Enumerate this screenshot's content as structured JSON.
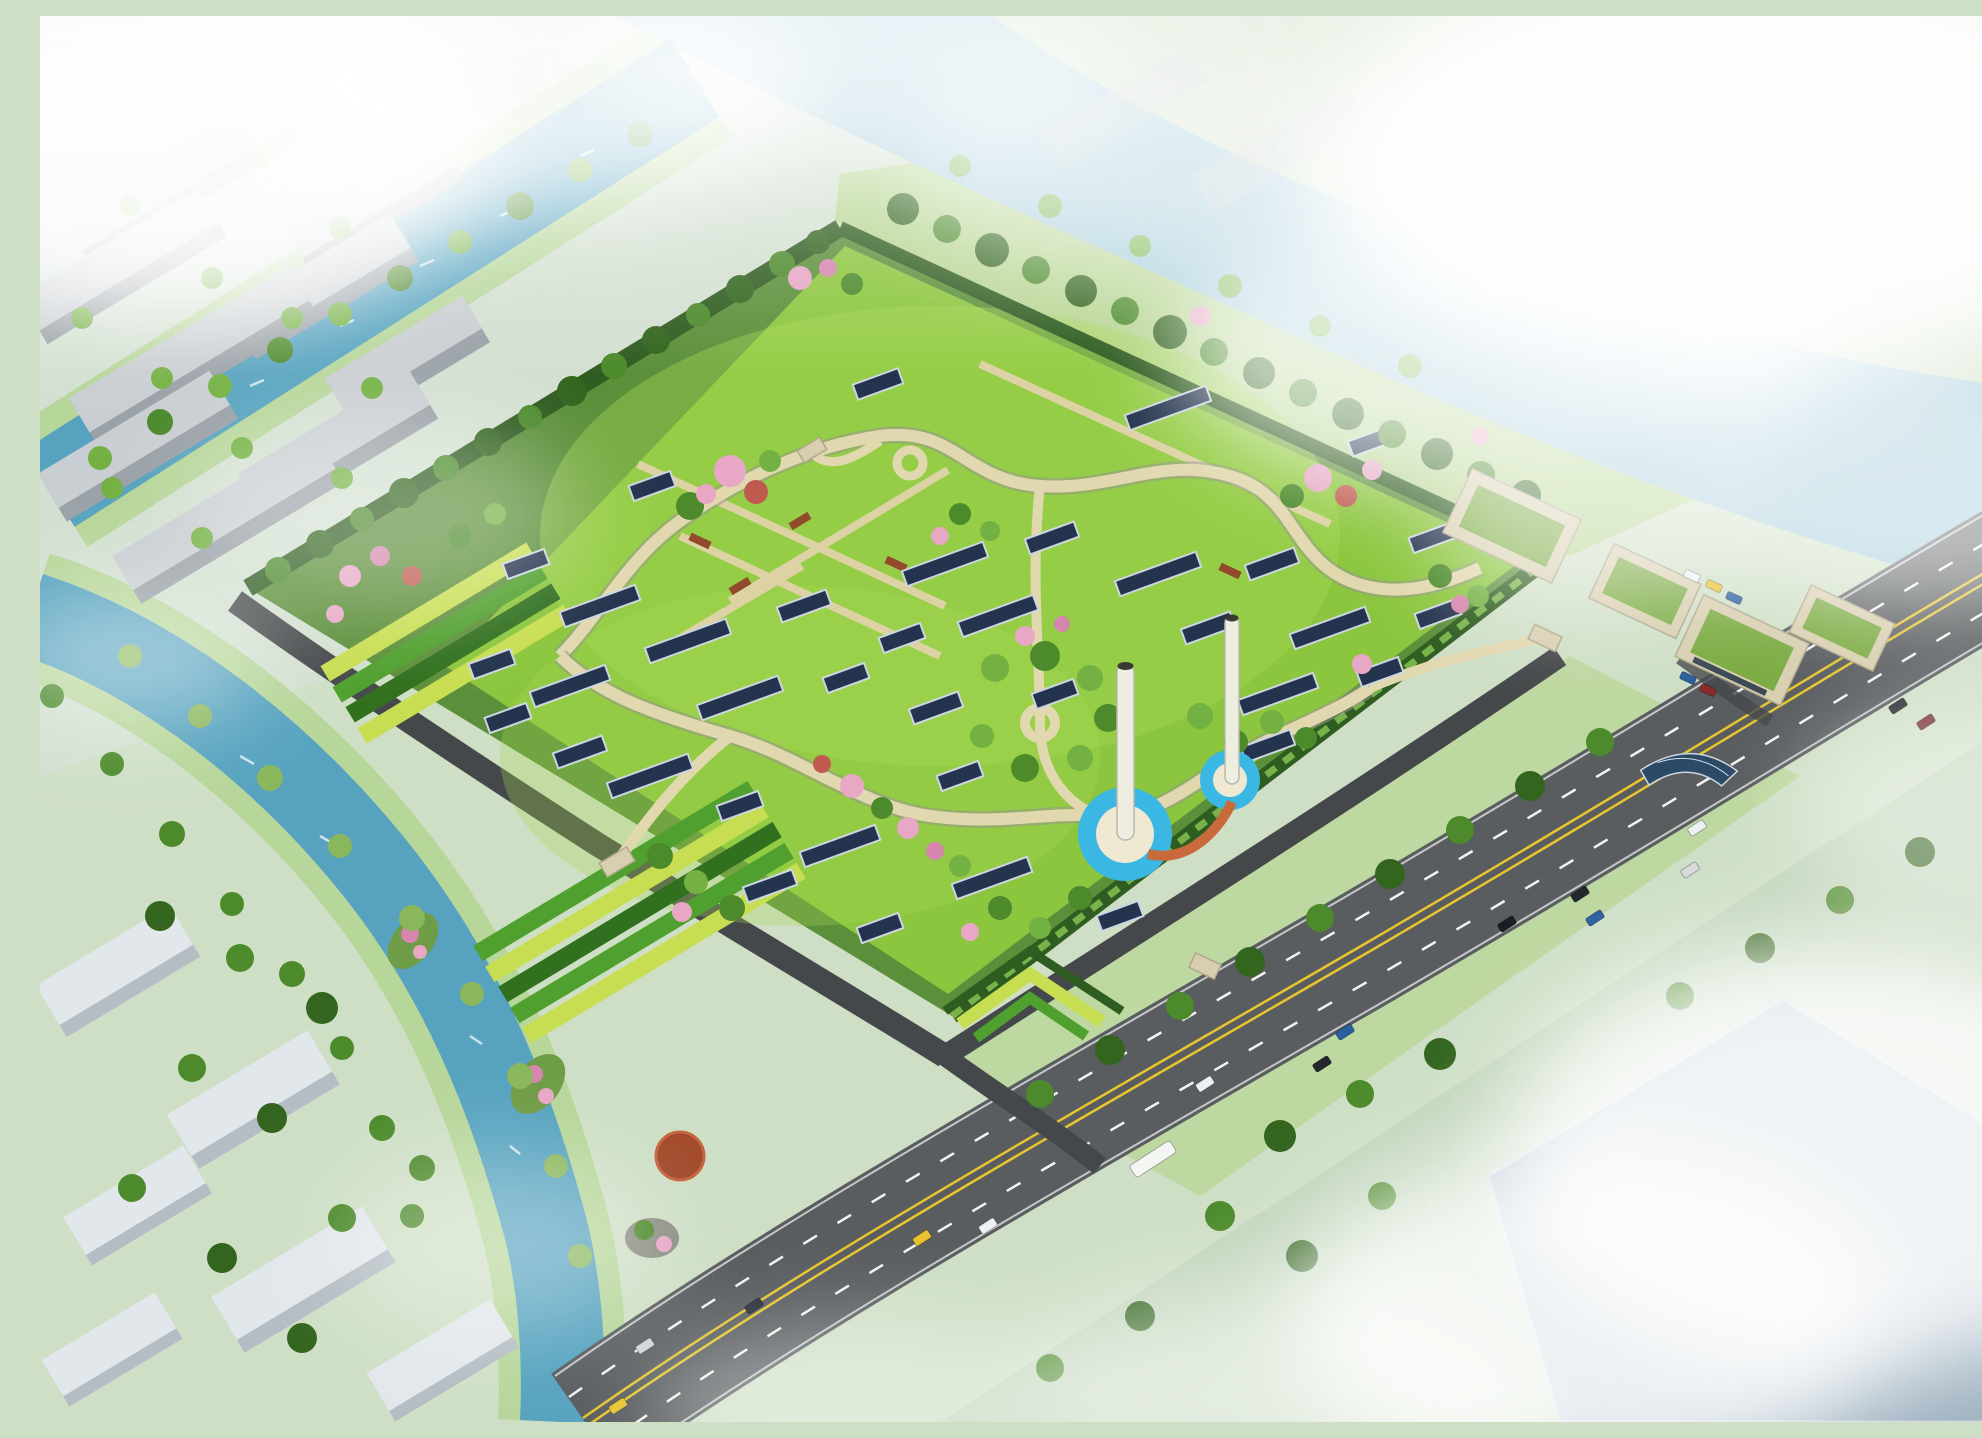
{
  "meta": {
    "alt": "Aerial architectural rendering: a large rhomboid green-roof park with winding paths, cherry blossoms, skylights, two white stacks in round blue pools, terraced planting slopes, surrounded by canals, a river, a highway with traffic, industrial sheds and fog"
  },
  "palette": {
    "bgGround": "#cfdfc6",
    "tintHaze": "#d6e1d8",
    "tintShade": "#b8cdb2",
    "riverWater": "#9fc9d8",
    "canalWater": "#57a3bf",
    "bankGreen": "#b7d69a",
    "lawnOutside": "#b3d488",
    "bermGreen": "#5c8f3a",
    "lawn": "#8cc63e",
    "lawnLight": "#a5d854",
    "hedge": "#2f5c20",
    "hedgeLight": "#77b349",
    "treeDark": "#33651f",
    "treeMid": "#4c8a2b",
    "treeLight": "#74b143",
    "willow": "#8ab75c",
    "blossomPink": "#e7a7c5",
    "blossomDeep": "#d685ae",
    "blossomRed": "#c05a50",
    "skylight": "#24344e",
    "skylightFrame": "#ccd6e0",
    "path": "#e2d8b0",
    "pathEdge": "#97978c",
    "pathStraight": "#ddd2a4",
    "planterRed": "#93492c",
    "roadMain": "#595d5f",
    "roadPerimeter": "#45484a",
    "laneYellow": "#e6c52f",
    "laneWhite": "#f2f4f3",
    "terraceYellow": "#c8de52",
    "terraceGreen": "#4fa02e",
    "terraceDark": "#31701f",
    "poolBlue": "#3bb7e3",
    "poolRim": "#efe8d2",
    "towerWhite": "#edede2",
    "towerShade": "#b9b8a8",
    "connectorOrange": "#c96a3c",
    "industrialRoof": "#c9ced2",
    "industrialSide": "#9aa1a7",
    "slabWhite": "#e2e7eb",
    "slabSide": "#b4bdc4",
    "bigBuildingRoof": "#9db0bf",
    "bigBuildingEdge": "#c6d3dd",
    "adminWall": "#d8cfb0",
    "adminEdge": "#b0a88c",
    "adminRoof": "#7cab43",
    "windowDark": "#3c4a56",
    "solarPanel": "#2c4a66",
    "deckRed": "#a34a2c",
    "deckRim": "#c2663e",
    "islandGreen": "#6f9c46",
    "rockGray": "#8c8f85",
    "fog": "#ffffff",
    "sparkle": "#ffffff"
  },
  "scene": {
    "site": "rhomboid green-roof park",
    "features": [
      "winding-walkway",
      "skylight-strips",
      "blossom-clusters",
      "twin-stacks-with-pools",
      "terraced-planting-beds",
      "living-wall",
      "admin-buildings",
      "curved-solar-canopy"
    ],
    "context": [
      "river",
      "canals",
      "flower-islands",
      "red-deck",
      "highway-with-traffic",
      "industrial-sheds",
      "white-slab-buildings",
      "large-gray-building",
      "fog"
    ]
  }
}
